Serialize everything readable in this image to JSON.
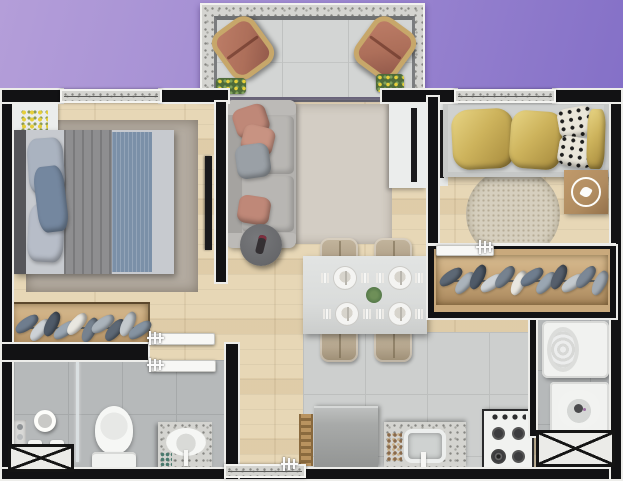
{
  "scene": {
    "title": "apartment-floor-plan-3d-render",
    "view": "top-down",
    "canvas": {
      "width": 623,
      "height": 481
    }
  },
  "palette": {
    "bgFrom": "#b49ed9",
    "bgTo": "#7c68c4",
    "wall": "#121214",
    "wallOutline": "#ededea",
    "wood": "#e7d7b6",
    "kitchenTile": "#cdcfce",
    "kitchenTileLine": "#bdbfbe",
    "bathTile": "#b6b9ba",
    "bathTileLine": "#a6a9aa",
    "balconyFloor": "#d3d5d4",
    "granite": "#d4d4d0",
    "rugLiving": "#d3cdc4",
    "rugBed1": "#b3aba0",
    "rugBed2": "#d6cfbe",
    "sofa": "#b3b1ae",
    "salmon": "#bf8878",
    "pillowGray": "#9aa0a6",
    "headboard": "#56565a",
    "blanket": "#8e8e90",
    "runnerBlue": "#7b90a8",
    "sheet": "#c7cacf",
    "pillowBlue": "#74879f",
    "gold": "#cdb35c",
    "goldDeep": "#a88c3e",
    "patternCream": "#eae6da",
    "bedFrame": "#c6c8c7",
    "closetWood": "#c9a97c",
    "sideWood": "#b08c60",
    "tableTop": "#dadcdb",
    "chairBeige": "#b5a68e",
    "terracotta": "#ad6f5a",
    "rattan": "#c7a76a",
    "fridge": "#a8aaa9",
    "applianceWhite": "#f1f2f0",
    "burner": "#3c3c3e",
    "darkTable": "#67686b",
    "tv": "#1a1a1c",
    "whiteFurniture": "#ebedec",
    "plantGreen": "#567a4a",
    "flowerYellow": "#e6cf3a"
  },
  "rooms": [
    {
      "name": "balcony",
      "floor": "gray-tile",
      "contents": [
        "rattan-lounge-chair",
        "rattan-lounge-chair",
        "flower-planter",
        "flower-planter"
      ]
    },
    {
      "name": "bedroom-1",
      "floor": "wood",
      "contents": [
        "double-bed-gray-blue",
        "nightstand-with-yellow-flowers",
        "area-rug",
        "wall-tv",
        "open-wardrobe-rack"
      ]
    },
    {
      "name": "living-room",
      "floor": "wood",
      "contents": [
        "gray-sofa",
        "accent-pillows",
        "round-side-table-with-remote",
        "area-rug",
        "tv-cabinet"
      ]
    },
    {
      "name": "dining-area",
      "floor": "wood",
      "contents": [
        "dining-table",
        "four-chairs",
        "four-place-settings",
        "centerpiece-plant"
      ]
    },
    {
      "name": "bedroom-2",
      "floor": "wood",
      "contents": [
        "bed-gold-bedding",
        "patterned-cushions",
        "round-rug",
        "wood-side-table-with-flower-tray",
        "open-wardrobe-rack"
      ]
    },
    {
      "name": "bathroom",
      "floor": "gray-tile",
      "contents": [
        "shower-area",
        "glass-partition",
        "toilet",
        "granite-sink-counter",
        "shaft-crossed-box"
      ]
    },
    {
      "name": "kitchen",
      "floor": "gray-tile",
      "contents": [
        "step-ladder",
        "refrigerator",
        "granite-counter-with-sink",
        "gas-stove-4-burners"
      ]
    },
    {
      "name": "laundry",
      "floor": "gray-tile",
      "contents": [
        "top-load-washer",
        "laundry-tub",
        "shaft-crossed-box"
      ]
    }
  ],
  "symbols": {
    "shaft": "crossed-box",
    "door": "open-white-leaf-with-trident-handle",
    "window": "speckled-granite-sill"
  },
  "closets": {
    "wardrobe1": {
      "item_colors": [
        "#6f7d8e",
        "#cdd2d6",
        "#4f5a68",
        "#9aa6b2",
        "#e9e7e0",
        "#76828f",
        "#aab3bb",
        "#5d6875",
        "#c3c9cd",
        "#8593a1"
      ]
    },
    "wardrobe2": {
      "item_colors": [
        "#5d6875",
        "#aab3bb",
        "#4f5a68",
        "#cdd2d6",
        "#76828f",
        "#e9e7e0",
        "#6f7d8e",
        "#9aa6b2",
        "#565f6c",
        "#c3c9cd",
        "#7c8896",
        "#a2abb4"
      ]
    }
  }
}
